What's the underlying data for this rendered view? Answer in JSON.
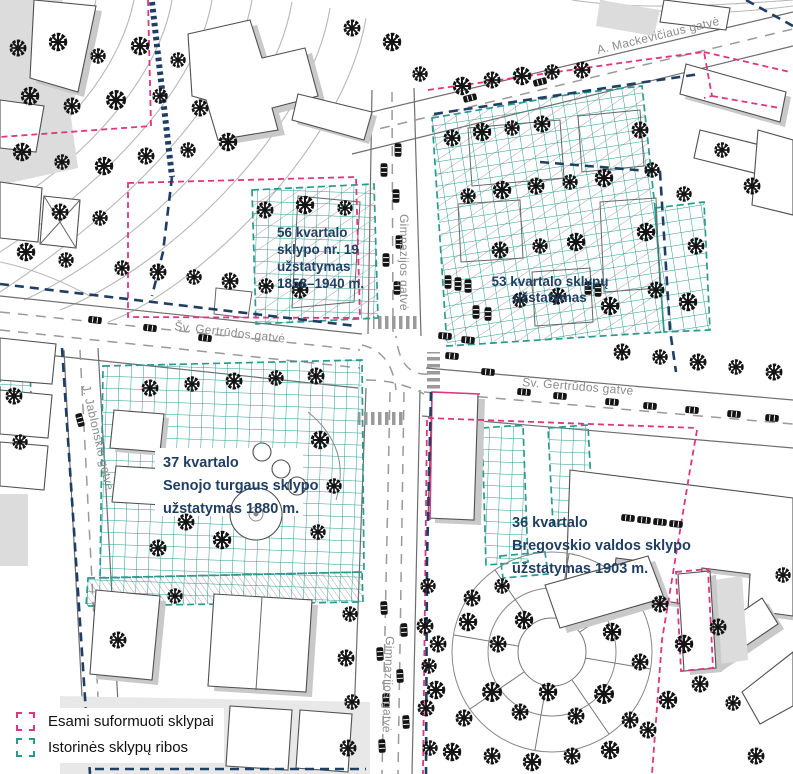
{
  "annotations": {
    "block56": {
      "line1": "56 kvartalo",
      "line2": "sklypo nr. 19",
      "line3": "užstatymas",
      "line4": "1858–1940 m."
    },
    "block53": {
      "line1": "53 kvartalo sklypų",
      "line2": "užstatymas"
    },
    "block37": {
      "line1": "37 kvartalo",
      "line2": "Senojo turgaus sklypo",
      "line3": "užstatymas 1880 m."
    },
    "block36": {
      "line1": "36 kvartalo",
      "line2": "Bregovskio valdos sklypo",
      "line3": "užstatymas 1903 m."
    }
  },
  "streets": {
    "mackeviciaus": "A. Mackevičiaus gatvė",
    "gertrudos": "Šv. Gertrūdos gatvė",
    "gimnazijos": "Gimnazijos gatvė",
    "jablonskio": "J. Jablonskio gatvė"
  },
  "legend": {
    "items": [
      {
        "label": "Esami suformuoti sklypai",
        "color": "#e0357f"
      },
      {
        "label": "Istorinės sklypų ribos",
        "color": "#2a9a8f"
      }
    ]
  },
  "colors": {
    "existing_plot_boundary": "#e0357f",
    "historic_plot_boundary": "#2a9a8f",
    "planning_boundary_navy": "#1f3e63",
    "annotation_text": "#1f3e63",
    "street_label": "#8c8c8c"
  }
}
